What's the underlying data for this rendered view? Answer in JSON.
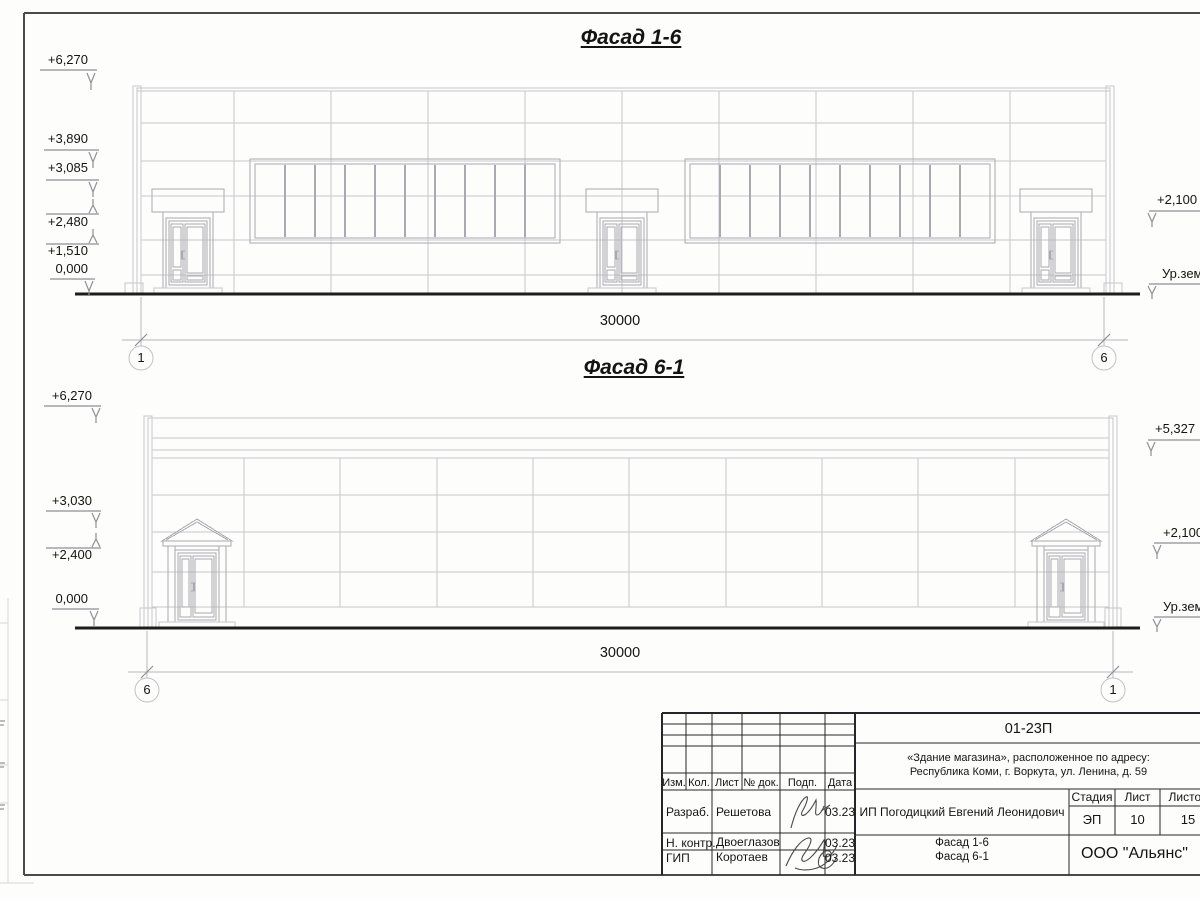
{
  "sheet": {
    "facade_top": {
      "title": "Фасад 1-6",
      "dimension": "30000",
      "axis_left": "1",
      "axis_right": "6",
      "levels_left": [
        "+6,270",
        "+3,890",
        "+3,085",
        "+2,480",
        "+1,510",
        "0,000"
      ],
      "levels_right": [
        "+2,100",
        "Ур.зем"
      ]
    },
    "facade_bottom": {
      "title": "Фасад 6-1",
      "dimension": "30000",
      "axis_left": "6",
      "axis_right": "1",
      "levels_left": [
        "+6,270",
        "+3,030",
        "+2,400",
        "0,000"
      ],
      "levels_right": [
        "+5,327",
        "+2,100",
        "Ур.зем"
      ]
    },
    "titleblock": {
      "doc_code": "01-23П",
      "object_line1": "«Здание магазина», расположенное по адресу:",
      "object_line2": "Республика Коми, г. Воркута, ул. Ленина, д. 59",
      "client": "ИП Погодицкий Евгений Леонидович",
      "cols": {
        "izm": "Изм.",
        "kol": "Кол.",
        "list": "Лист",
        "doc": "№ док.",
        "podp": "Подп.",
        "data": "Дата"
      },
      "stage_label": "Стадия",
      "sheet_label": "Лист",
      "sheets_label": "Листов",
      "stage": "ЭП",
      "sheet_no": "10",
      "sheets_total": "15",
      "drawing1": "Фасад 1-6",
      "drawing2": "Фасад 6-1",
      "company": "ООО \"Альянс\"",
      "rows": [
        {
          "role": "Разраб.",
          "name": "Решетова",
          "date": "03.23"
        },
        {
          "role": "Н. контр.",
          "name": "Двоеглазов",
          "date": "03.23"
        },
        {
          "role": "ГИП",
          "name": "Коротаев",
          "date": "03.23"
        }
      ]
    }
  }
}
